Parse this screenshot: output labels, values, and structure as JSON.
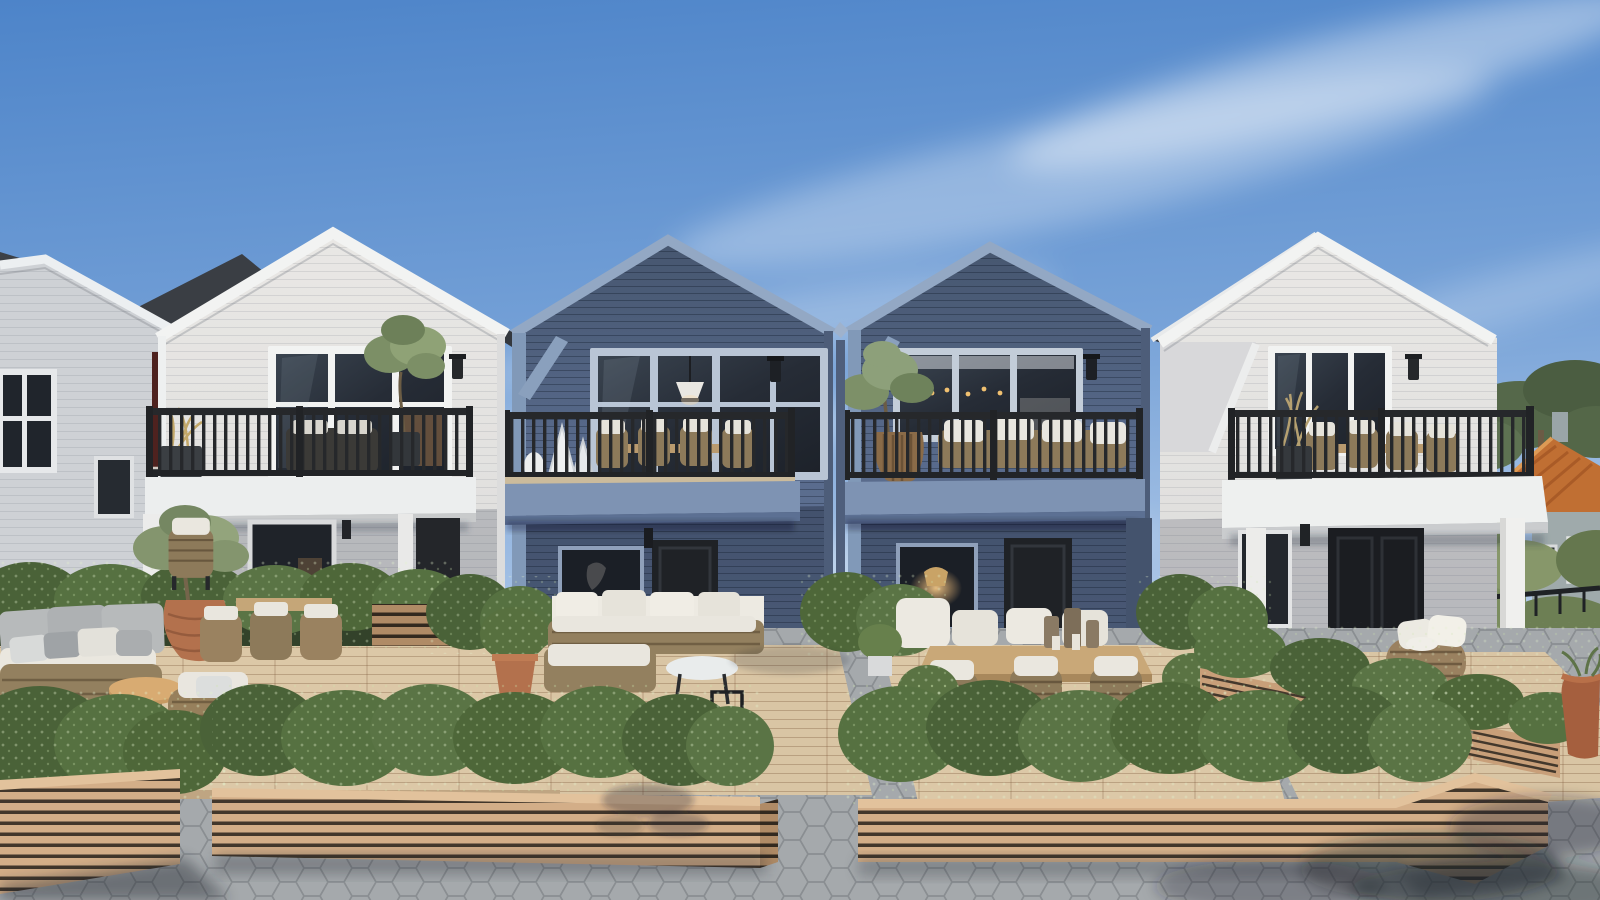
{
  "scene": {
    "title": "Townhouse development exterior rendering",
    "description": "Photorealistic daytime rendering of a row of four gabled two-storey townhouses (white, blue, blue, white) with black metal balcony railings, ground-floor wooden terraces with outdoor lounge and dining furniture, boxwood hedges in slatted timber planter boxes, and a hexagonal-paver courtyard walkway. Neighbouring grey and dark-red houses appear at left; a grey house with an orange tile roof and pine trees appear at right.",
    "sky": "clear blue with thin cirrus clouds",
    "time_of_day": "day"
  },
  "colors": {
    "sky_top": "#4d84c9",
    "sky_mid": "#78a3d8",
    "sky_low": "#b3cbe9",
    "sky_horizon": "#dce8f5",
    "cloud": "#ffffff",
    "roof_dark": "#34383e",
    "white_wall": "#e4e3e1",
    "white_trim": "#f2f3f2",
    "white_wall_shade": "#d6d6d8",
    "blue_wall_top": "#46566f",
    "blue_wall_mid": "#57698a",
    "blue_wall_low": "#66799c",
    "blue_trim": "#93a8c4",
    "blue_slab": "#7e93b3",
    "blue_corner": "#8199b8",
    "red_wall": "#5c2a26",
    "gray_house_wall": "#ced1d5",
    "bg_house_wall": "#9faaab",
    "bg_house_roof": "#c06f33",
    "railing": "#26282b",
    "glass_dark": "#262c36",
    "hedge_dark": "#42592f",
    "hedge_mid": "#546d3d",
    "hedge_light": "#67804c",
    "planter_wood": "#d3ae88",
    "planter_gap": "#42372b",
    "deck_wood": "#dcc8a7",
    "paver": "#aaaeb1",
    "paver_line": "#8b8f93",
    "terracotta": "#b3714d",
    "wicker": "#93805f",
    "cushion_white": "#eae7df",
    "cushion_gray": "#b7babb",
    "lamp_glow": "#e8b878",
    "tree_green": "#7c8f66",
    "pine_green": "#55684a",
    "shadow": "#1f242b"
  },
  "houses": [
    {
      "id": "gray-house-left",
      "label": "neighbouring grey house",
      "wall": "#ced1d5"
    },
    {
      "id": "red-house",
      "label": "dark red house",
      "wall": "#5c2a26"
    },
    {
      "id": "townhouse-1",
      "label": "white townhouse (left)",
      "wall": "#e4e3e1",
      "trim": "#f2f3f2",
      "roof": "#34383e"
    },
    {
      "id": "townhouse-2",
      "label": "blue townhouse (centre-left)",
      "wall": "#57698a",
      "trim": "#93a8c4",
      "roof": "#34383e"
    },
    {
      "id": "townhouse-3",
      "label": "blue townhouse (centre-right)",
      "wall": "#57698a",
      "trim": "#93a8c4",
      "roof": "#34383e"
    },
    {
      "id": "townhouse-4",
      "label": "white townhouse (right)",
      "wall": "#e4e3e1",
      "trim": "#f2f3f2",
      "roof": "#34383e"
    },
    {
      "id": "bg-house-right",
      "label": "grey house with orange tile roof",
      "wall": "#9faaab",
      "roof": "#c06f33"
    }
  ],
  "landscape": {
    "planter_boxes": 4,
    "hedge_rows": 6,
    "patios": 4,
    "walkway": "hexagonal concrete pavers",
    "balconies": 4
  },
  "furniture": {
    "left_patio": [
      "wicker sofa with grey cushions",
      "round wood coffee table",
      "wicker armchair",
      "terracotta urn with olive tree",
      "wicker dining chairs"
    ],
    "patio_2": [
      "corner sofa with white cushions",
      "white round coffee table",
      "black candle lanterns",
      "potted shrub in terracotta pot"
    ],
    "patio_3": [
      "teak dining table",
      "six wicker dining chairs with white cushions",
      "candle set",
      "boxwood topiaries in white pots"
    ],
    "patio_4": [
      "round wicker lounge chair with white cushions",
      "terracotta planter"
    ]
  }
}
